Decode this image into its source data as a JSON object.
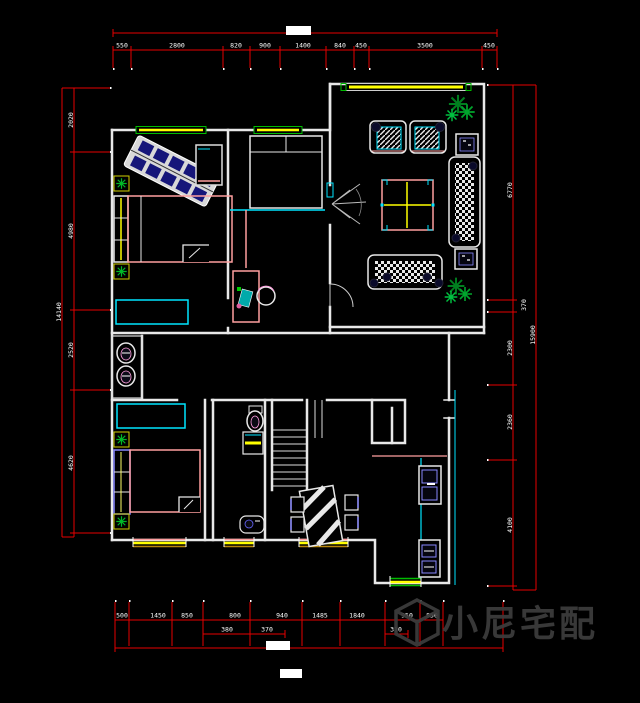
{
  "meta": {
    "type": "cad-floor-plan"
  },
  "watermark": {
    "brand": "小尼宅配",
    "logo": "cube-logo"
  },
  "colors": {
    "background": "#000000",
    "wall": "#e8e8e8",
    "dimension": "#e60000",
    "dim_text": "#ffffff",
    "window_green": "#00bb00",
    "window_yellow": "#ffff00",
    "accent_cyan": "#00e5ff",
    "accent_pink": "#ff9f9f",
    "plant_green": "#00a028",
    "watermark_gray": "#3c3c3c",
    "highlight_box": "#ffffff"
  },
  "dims": {
    "top": [
      "550",
      "2800",
      "820",
      "900",
      "1400",
      "840",
      "450",
      "3500",
      "450"
    ],
    "left": [
      "2020",
      "4980",
      "2520",
      "4620"
    ],
    "left_overall": "14140",
    "right": [
      "6770",
      "370",
      "2300",
      "2360",
      "4100"
    ],
    "right_overall": "15900",
    "bottom_row1": [
      "500",
      "1450",
      "850",
      "800",
      "940",
      "1485",
      "1840",
      "950",
      "850"
    ],
    "bottom_row2": [
      "380",
      "370",
      "310"
    ]
  },
  "icons": {
    "plant-icon": "green-asterisk-star",
    "stairs-icon": "parallel-treads",
    "door-swing-icon": "quarter-arc",
    "basin-icon": "ellipse-bowl",
    "toilet-icon": "ellipse-with-tank",
    "sofa-icon": "checker-hatch-rect",
    "armchair-icon": "diagonal-hatch-rect",
    "coffee-table-icon": "cross-square",
    "dining-table-icon": "diagonal-striped-rect",
    "sink-icon": "double-basin",
    "stove-icon": "double-burner",
    "bed-icon": "outline-rect",
    "wardrobe-icon": "cyan-rect",
    "washing-machine-icon": "yellow-striped-box",
    "watermark-logo": "cube-outline"
  }
}
